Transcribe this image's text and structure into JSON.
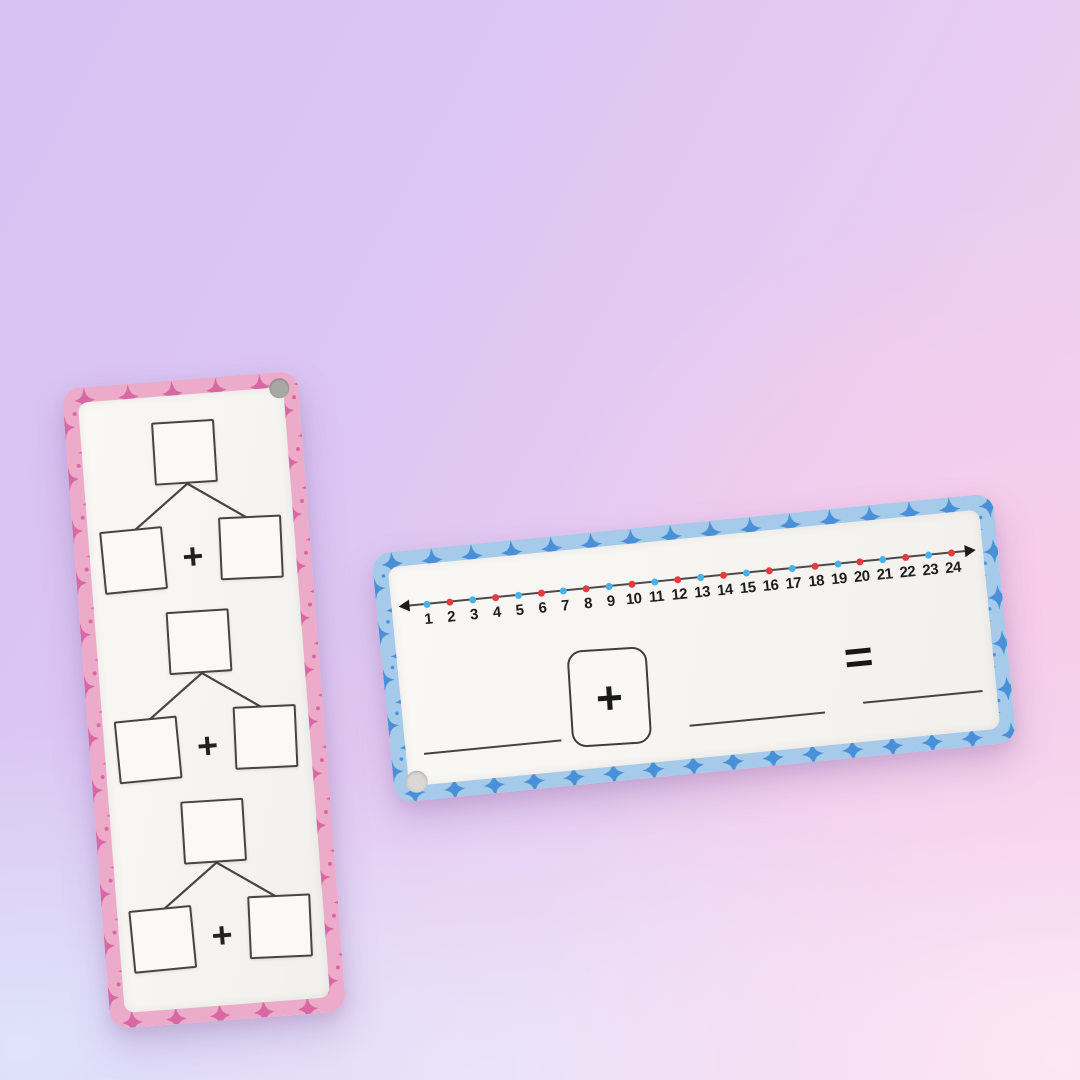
{
  "background": {
    "gradient_colors": {
      "top_left": "#d6c2f3",
      "top_right": "#e8ccf1",
      "mid_right_pink": "#f8cde9",
      "bottom_left": "#dfe4fa",
      "bottom_right": "#fde9f6"
    }
  },
  "pink_card": {
    "colors": {
      "border_base": "#ecacc9",
      "border_star": "#d london868a3",
      "panel": "#f8f6f2",
      "box_outline": "#47453f"
    },
    "hole_position": "top-right",
    "bonds": [
      {
        "operator": "+"
      },
      {
        "operator": "+"
      },
      {
        "operator": "+"
      }
    ]
  },
  "blue_card": {
    "colors": {
      "border_base": "#a6cbea",
      "border_star": "#4a90d8",
      "panel": "#f7f6f2",
      "line": "#4a4a48"
    },
    "hole_position": "bottom-left",
    "number_line": {
      "numbers": [
        1,
        2,
        3,
        4,
        5,
        6,
        7,
        8,
        9,
        10,
        11,
        12,
        13,
        14,
        15,
        16,
        17,
        18,
        19,
        20,
        21,
        22,
        23,
        24
      ],
      "odd_dot_color": "#48b2e8",
      "even_dot_color": "#e23c3c"
    },
    "equation": {
      "plus_symbol": "+",
      "equals_symbol": "=",
      "answer_blanks": 3
    }
  }
}
